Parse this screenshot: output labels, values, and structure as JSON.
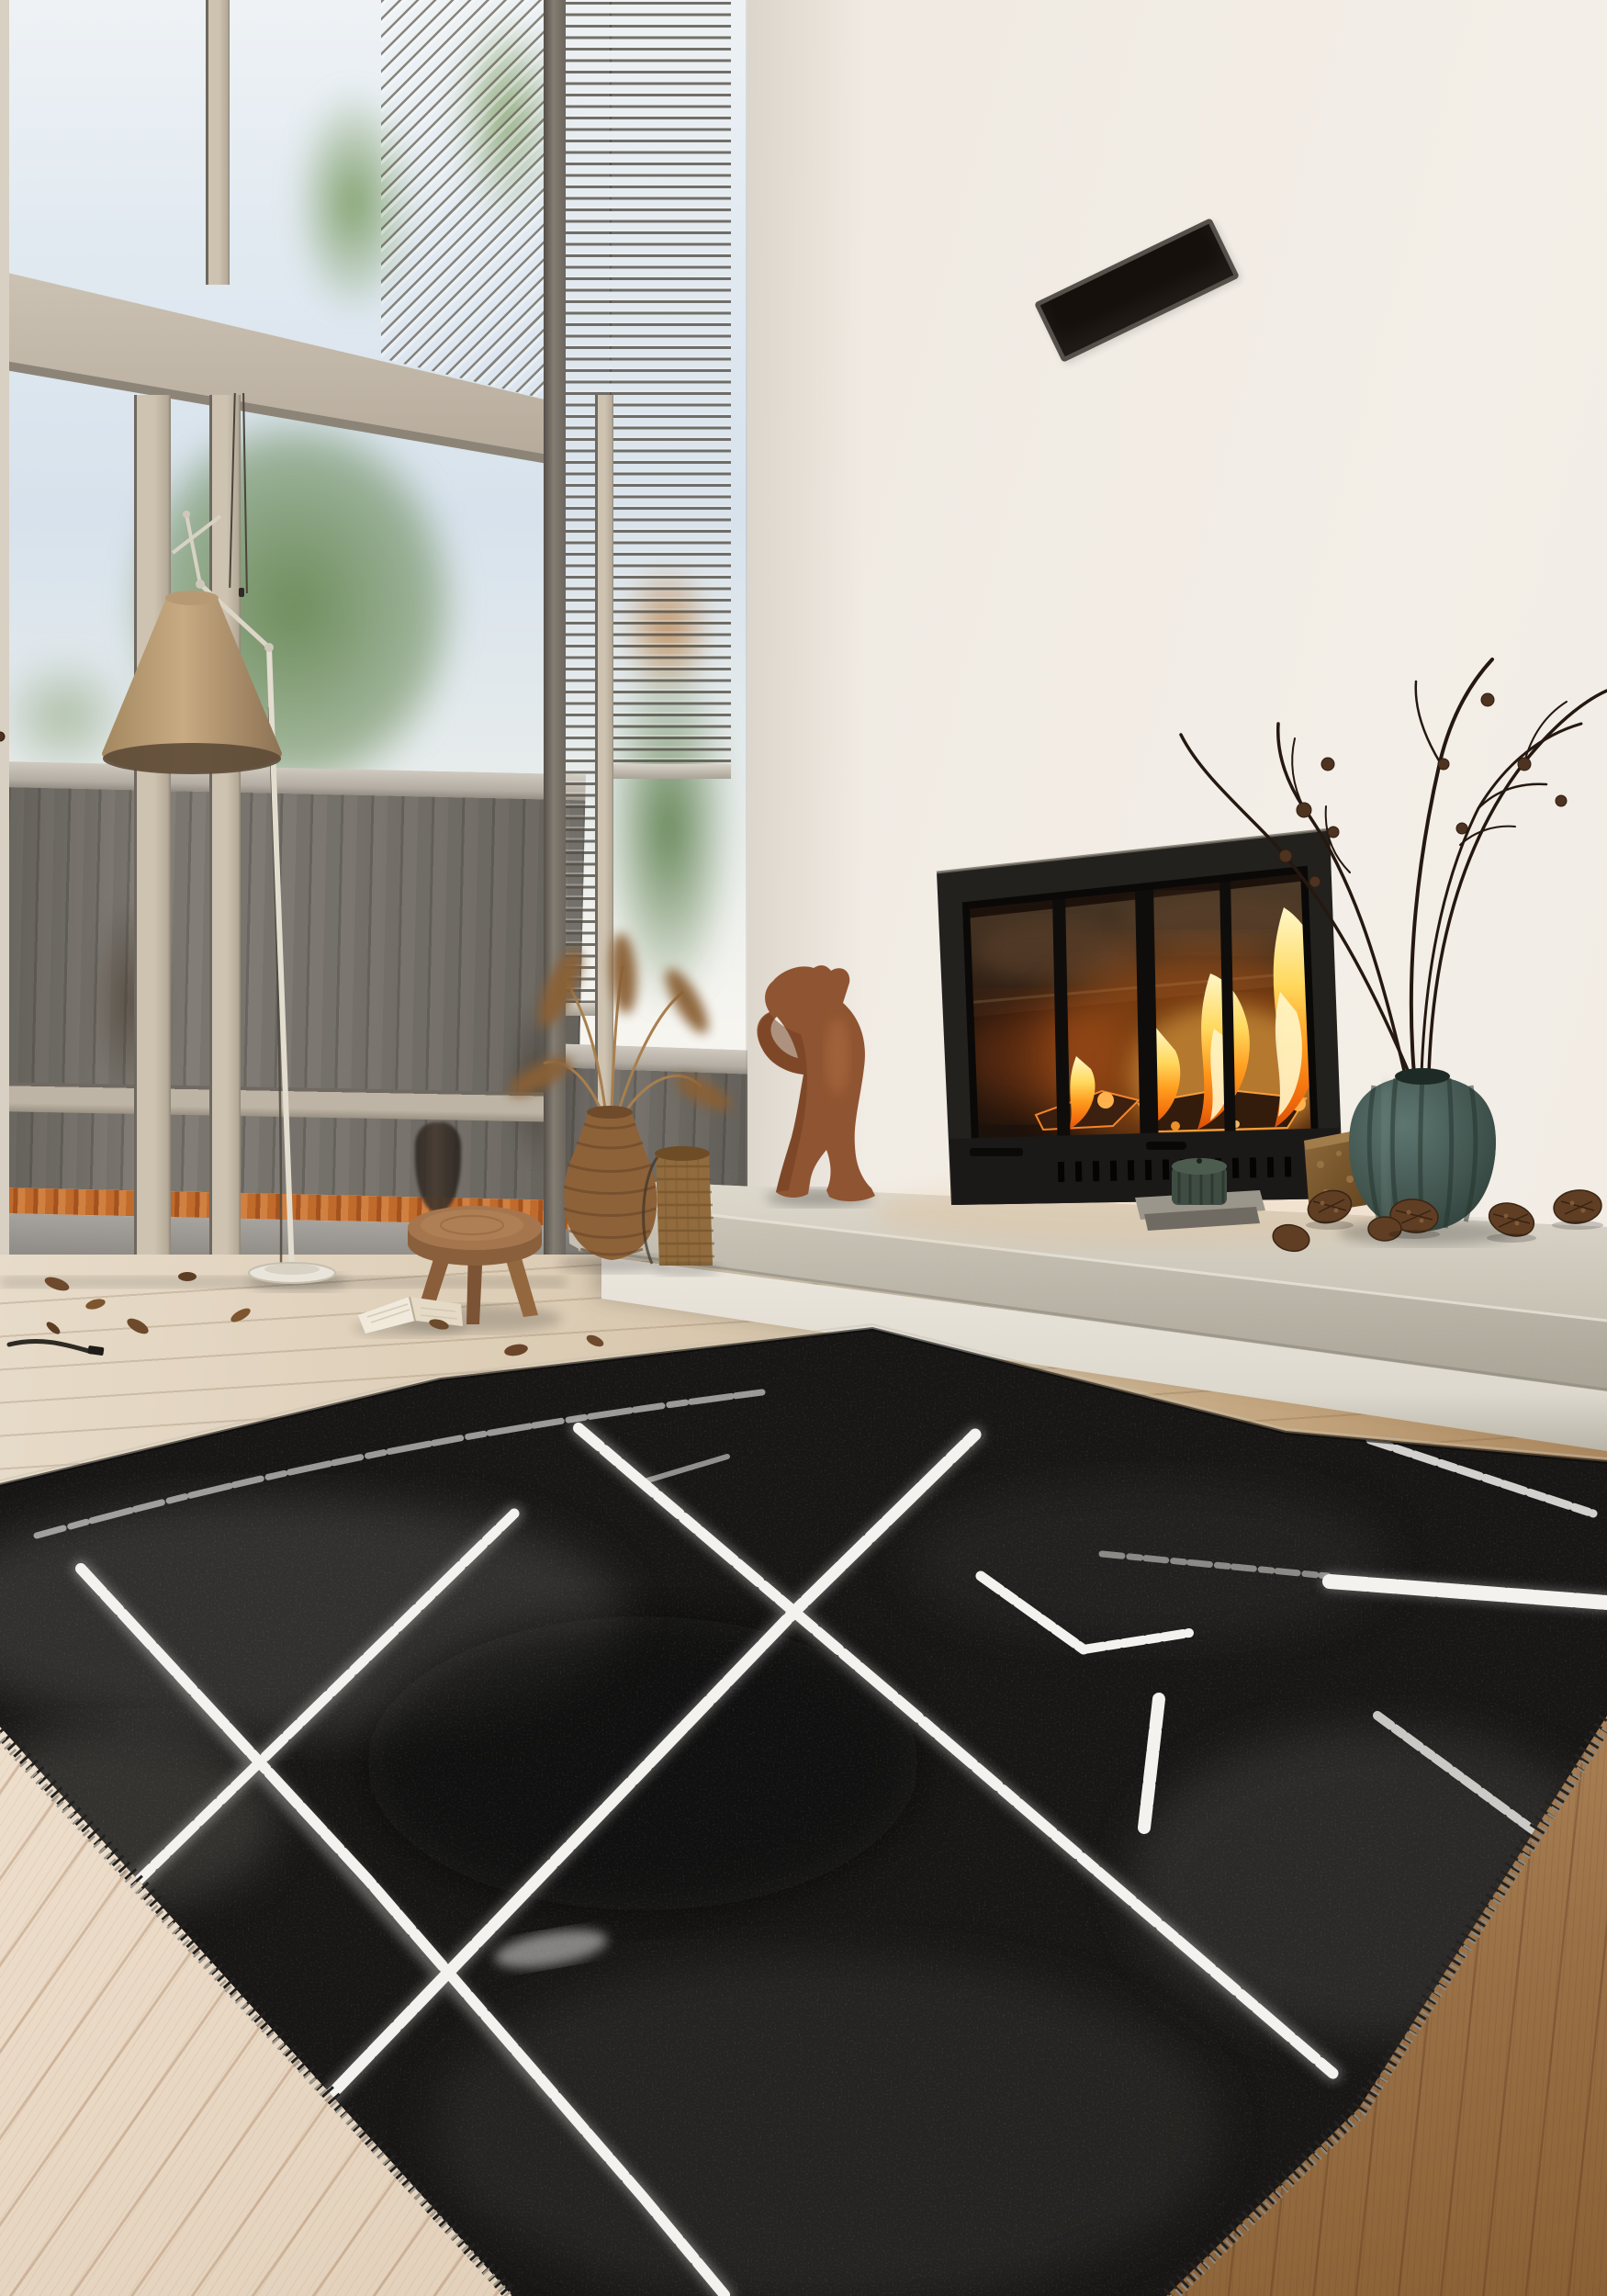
{
  "scene": {
    "type": "photograph",
    "description": "Modern double-height living room with floor-to-ceiling windows, a lit fireplace insert in a white wall, a long concrete bench, decor objects and a black berber rug with white geometric lines on a light wood floor."
  },
  "palette": {
    "wall": "#f0eae2",
    "sky": "#dfe8f0",
    "beam": "#cdc3b4",
    "fence_grey": "#74706a",
    "fence_rail": "#c2bcb2",
    "autumn_leaves": "#bc6a2b",
    "stone_ground": "#a19d98",
    "floor_light": "#e3d4bf",
    "floor_warm": "#a8835a",
    "floor_pale": "#ecdccb",
    "rug_black": "#171615",
    "rug_line": "#f3f2ee",
    "rug_fringe": "#93907f",
    "concrete": "#d6d0c4",
    "plinth": "#e9e4db",
    "fireplace_frame": "#24221f",
    "glass_dark": "#20140c",
    "flame_core": "#fff3b8",
    "flame_mid": "#ffc24d",
    "flame_deep": "#f07312",
    "terracotta": "#8f5431",
    "vase_teal": "#41544e",
    "stool_wood": "#a5764e",
    "wicker": "#8d6238",
    "basket": "#916b3d",
    "lamp_shade": "#bfa27a",
    "lamp_cream": "#e4decf",
    "branch": "#2a1c12",
    "pine_cone": "#5d3c24",
    "vent_black": "#15100c",
    "outlet_plate": "#e9e3d8",
    "book_page": "#f0e9dc",
    "candle_green": "#3f4c42",
    "box_wood": "#7e5c34"
  },
  "objects": [
    {
      "name": "window-wall",
      "description": "two-storey glazing with beige mullions and a structural beam"
    },
    {
      "name": "venetian-blinds",
      "description": "partially lowered slat blinds, diagonal in corner pane"
    },
    {
      "name": "garden-fence",
      "description": "grey vertical plank fence with cap rail, autumn leaves at its base"
    },
    {
      "name": "pine-trees",
      "description": "green conifers seen through the glass"
    },
    {
      "name": "floor-lamp",
      "description": "tan cone shade on cream articulated stand with round base"
    },
    {
      "name": "blind-cords",
      "description": "two control cords hanging at the glass"
    },
    {
      "name": "fireplace-insert",
      "description": "black framed glass fireplace with burning logs"
    },
    {
      "name": "concrete-bench",
      "description": "long floating concrete hearth bench on white plinth"
    },
    {
      "name": "wooden-sculpture",
      "description": "terracotta abstract figure with raised arms"
    },
    {
      "name": "candle",
      "description": "dark green ribbed candle on stone slabs"
    },
    {
      "name": "teal-vase",
      "description": "ribbed pumpkin-shaped teal vase with dry branches"
    },
    {
      "name": "dry-branches",
      "description": "bare twigs with small cones"
    },
    {
      "name": "pine-cones",
      "description": "scattered on the bench top"
    },
    {
      "name": "wooden-box",
      "description": "bark-textured block beside the fireplace"
    },
    {
      "name": "wicker-vase",
      "description": "tall rattan vase with dried plumes"
    },
    {
      "name": "wicker-basket",
      "description": "small woven cylinder basket"
    },
    {
      "name": "wooden-stool",
      "description": "round three-legged stool"
    },
    {
      "name": "open-book",
      "description": "open book lying on the floor"
    },
    {
      "name": "fallen-leaves",
      "description": "dry leaves scattered on the floor"
    },
    {
      "name": "power-outlets",
      "description": "two round european sockets on the plinth"
    },
    {
      "name": "air-vent",
      "description": "black slot vent high on the white wall"
    },
    {
      "name": "berber-rug",
      "description": "black rug with white chalky lattice lines and fringed edges"
    },
    {
      "name": "wood-floor",
      "description": "pale oak planks, warmer toward the right"
    }
  ]
}
